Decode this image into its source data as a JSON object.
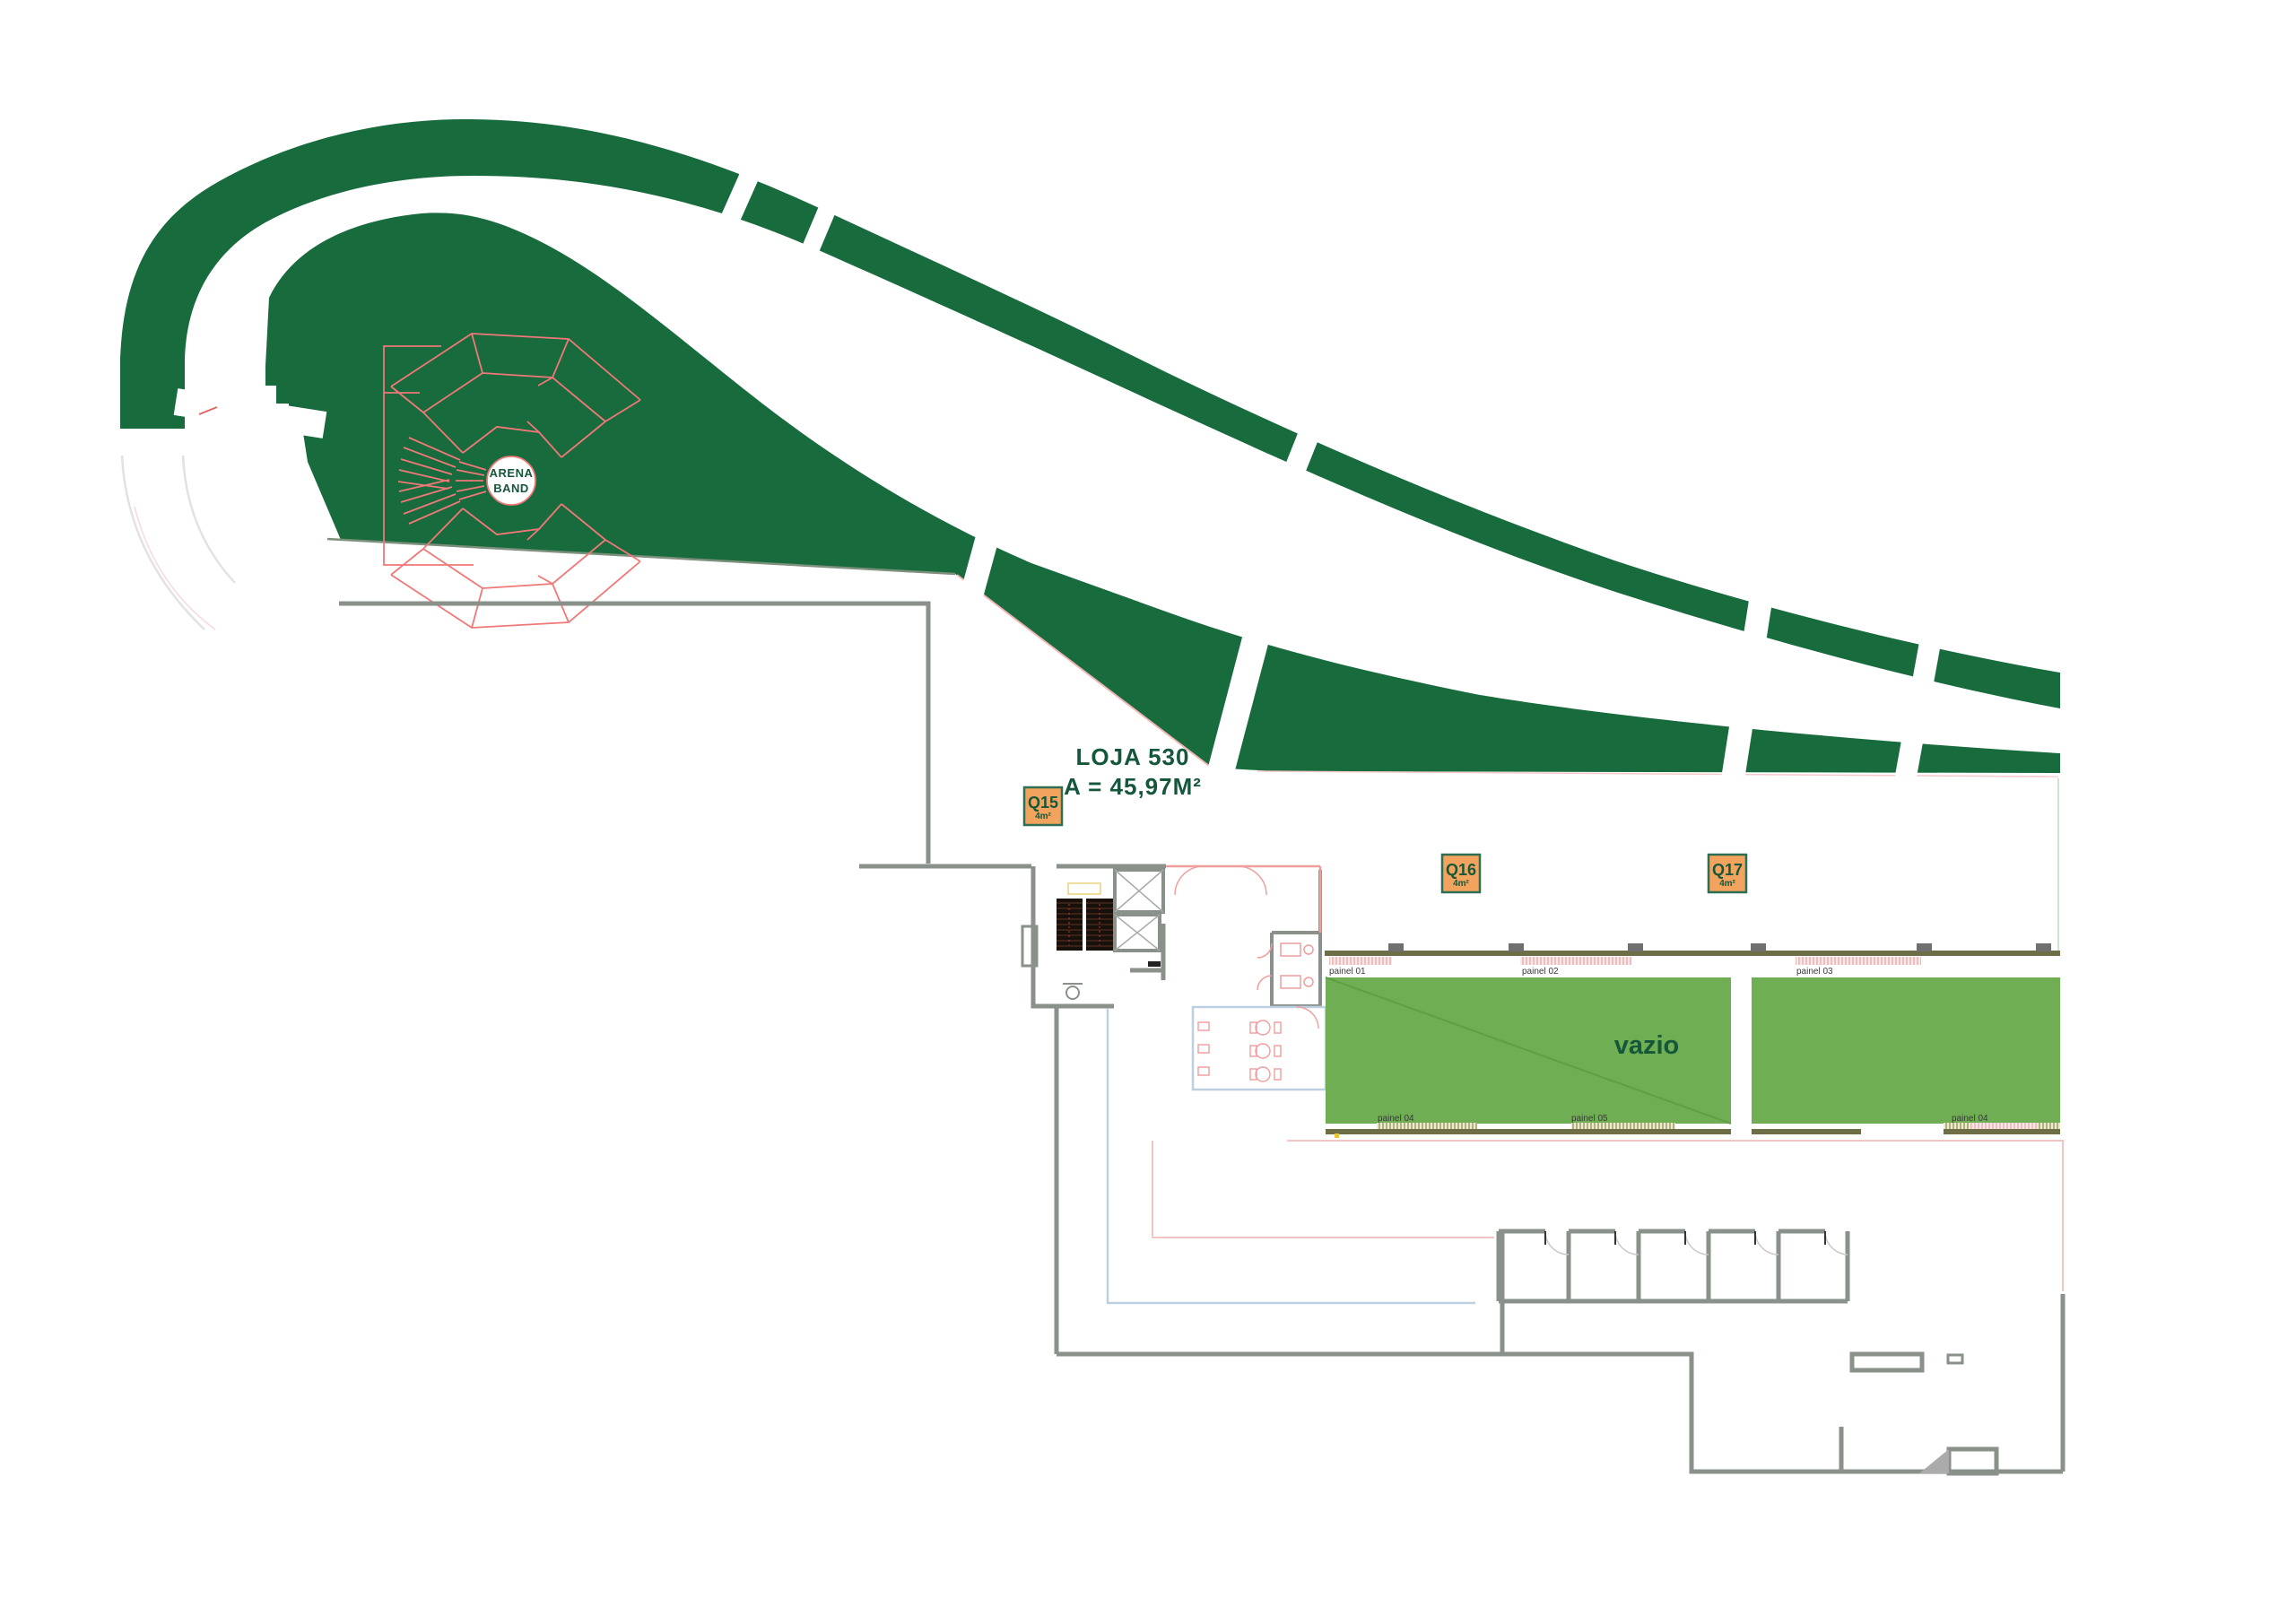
{
  "plan": {
    "title": "Mall floor plan - LOJA 530",
    "loja": {
      "name": "LOJA 530",
      "area": "A = 45,97M²"
    },
    "kiosks": [
      {
        "id": "Q15",
        "size": "4m²"
      },
      {
        "id": "Q16",
        "size": "4m²"
      },
      {
        "id": "Q17",
        "size": "4m²"
      }
    ],
    "arena": {
      "line1": "ARENA",
      "line2": "BAND"
    },
    "rooms": {
      "vazio": "vazio"
    },
    "panels": {
      "top": [
        "painel 01",
        "painel 02",
        "painel 03"
      ],
      "bottom": [
        "painel 04",
        "painel 05",
        "painel 04"
      ]
    },
    "colors": {
      "walkway_green": "#176b3d",
      "room_green": "#6fae53",
      "kiosk_orange": "#f2a35e",
      "red_line": "#f07878",
      "wall_gray": "#8a918a",
      "wall_olive": "#6e6e46",
      "text_green": "#14573b"
    }
  }
}
